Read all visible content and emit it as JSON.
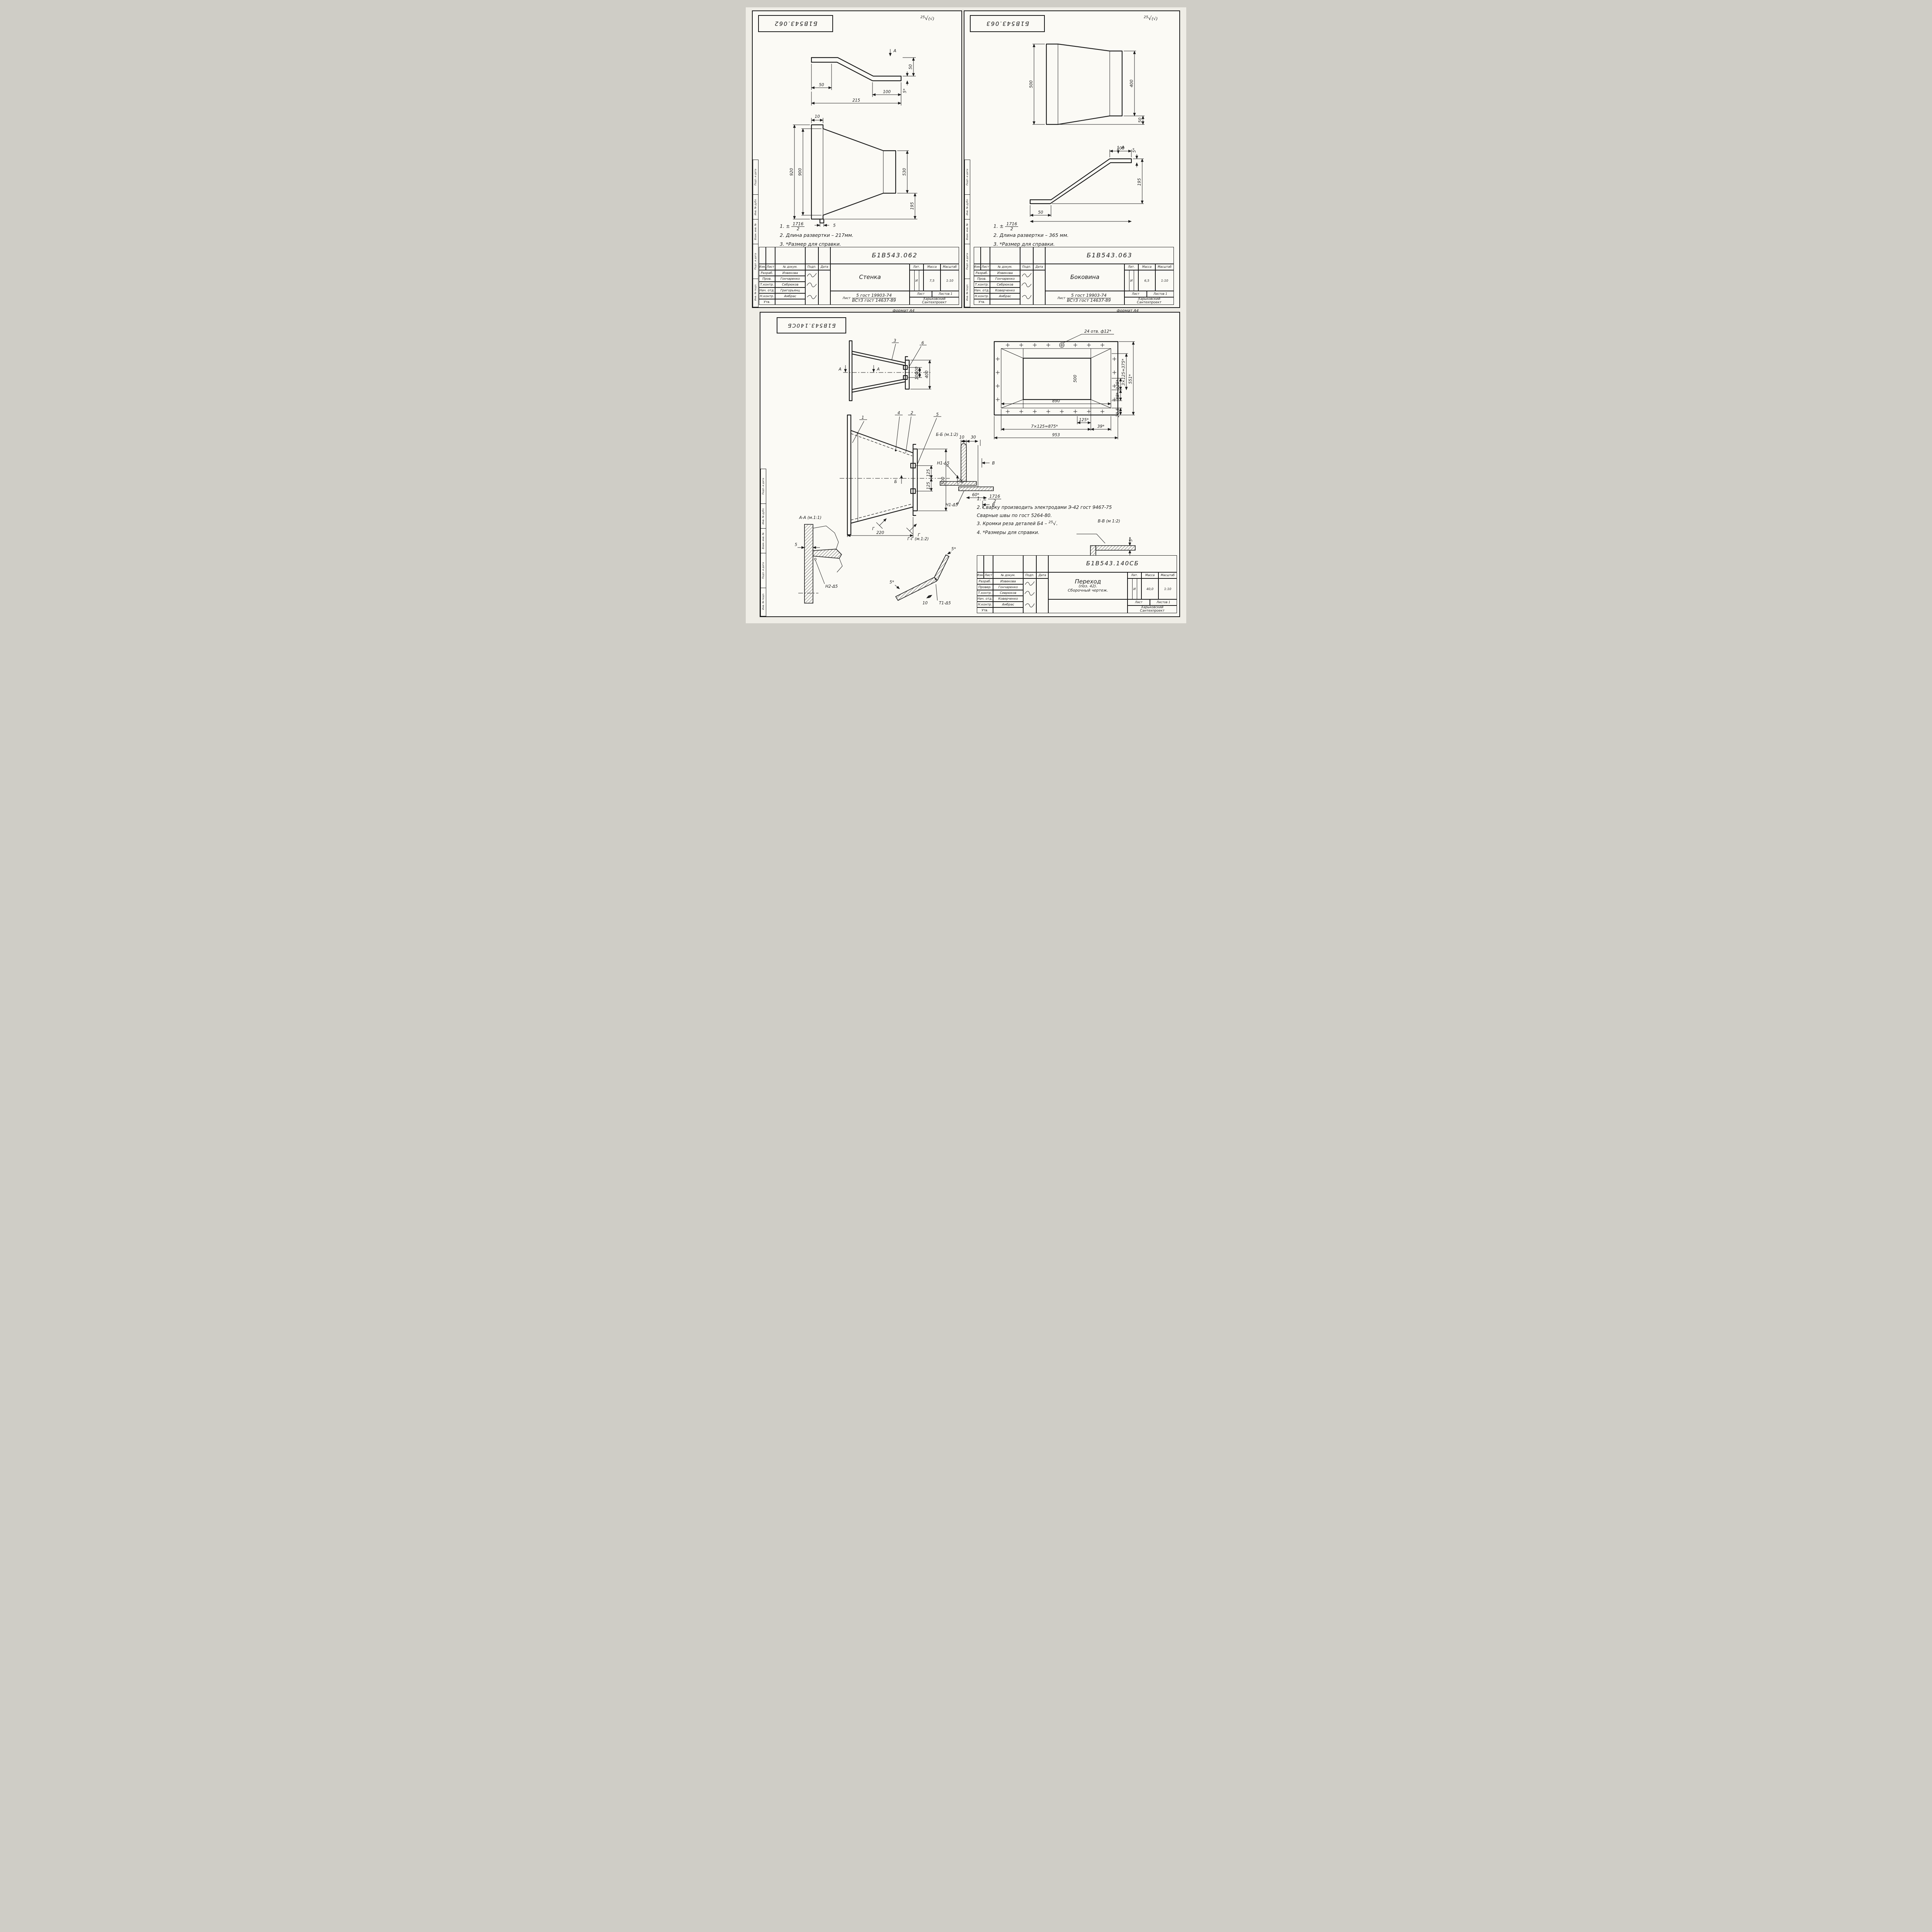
{
  "page": {
    "album_label": "Альбом 16",
    "check": "√",
    "check_paren": "(√)"
  },
  "frame_labels": {
    "l1": "Подп. и дата",
    "l2": "Инв. № дубл.",
    "l3": "Взам. инв. №",
    "l4": "Подп. и дата",
    "l5": "Инв. № подл."
  },
  "hdr": {
    "izm": "Изм.",
    "list": "Лист",
    "doc": "№ докум.",
    "podp": "Подп.",
    "data": "Дата",
    "lit": "Лит.",
    "massa": "Масса",
    "masshtab": "Масштаб",
    "list2": "Лист",
    "listov": "Листов"
  },
  "sheets": [
    {
      "doc_number": "Б1В543.062",
      "format_label": "формат А4",
      "roughness": {
        "value": "25"
      },
      "titleblock": {
        "doc_number": "Б1В543.062",
        "name": "Стенка",
        "lit": "И",
        "massa": "7,5",
        "scale": "1:10",
        "material_prefix": "Лист",
        "material_top": "5 гост 19903-74",
        "material_bottom": "ВСт3 гост 14637-89",
        "org1": "Харьковский",
        "org2": "Сантехпроект",
        "listov_value": "1",
        "staff": [
          {
            "role": "Разраб.",
            "name": "Извекова"
          },
          {
            "role": "Пров.",
            "name": "Гончаренко"
          },
          {
            "role": "Т.контр.",
            "name": "Себрюков"
          },
          {
            "role": "Нач. отд.",
            "name": "Григорьянц"
          },
          {
            "role": "Н.контр.",
            "name": "Амбрас"
          },
          {
            "role": "Утв.",
            "name": ""
          }
        ]
      },
      "notes": {
        "n1_prefix": "1. ±",
        "n1_num": "1716",
        "n1_den": "2",
        "n2": "2. Длина развертки – 217мм.",
        "n3": "3. *Размер для справки."
      },
      "dims": {
        "v1": {
          "d50l": "50",
          "d100": "100",
          "d215": "215",
          "d50r": "50",
          "d5s": "5*",
          "a": "А"
        },
        "v2": {
          "d10": "10",
          "d920": "920",
          "d900": "900",
          "d530": "530",
          "d195": "195",
          "d5": "5"
        }
      }
    },
    {
      "doc_number": "Б1В543.063",
      "format_label": "формат А4",
      "roughness": {
        "value": "25"
      },
      "titleblock": {
        "doc_number": "Б1В543.063",
        "name": "Боковина",
        "lit": "И",
        "massa": "6,5",
        "scale": "1:10",
        "material_prefix": "Лист",
        "material_top": "5 гост 19903-74",
        "material_bottom": "ВСт3 гост 14637-89",
        "org1": "Харьковский",
        "org2": "Сантехпроект",
        "listov_value": "1",
        "staff": [
          {
            "role": "Разраб.",
            "name": "Извекова"
          },
          {
            "role": "Пров.",
            "name": "Гончаренко"
          },
          {
            "role": "Т.контр.",
            "name": "Себрюков"
          },
          {
            "role": "Нач. отд.",
            "name": "Коверченко"
          },
          {
            "role": "Н.контр.",
            "name": "Амбрас"
          },
          {
            "role": "Утв.",
            "name": ""
          }
        ]
      },
      "notes": {
        "n1_prefix": "1. ±",
        "n1_num": "1716",
        "n1_den": "2",
        "n2": "2. Длина развертки – 365 мм.",
        "n3": "3. *Размер для справки."
      },
      "dims": {
        "v1": {
          "d500": "500",
          "d400": "400",
          "d50": "50"
        },
        "v2": {
          "d50": "50",
          "d100": "100",
          "d195": "195",
          "d5s": "5*",
          "a": "А"
        }
      }
    },
    {
      "doc_number": "Б1В543.140СБ",
      "titleblock": {
        "doc_number": "Б1В543.140СБ",
        "name": "Переход",
        "name_sub": "(поз. 42).",
        "name_type": "Сборочный чертеж.",
        "lit": "И",
        "massa": "40,0",
        "scale": "1:10",
        "material_prefix": "",
        "material_top": "",
        "material_bottom": "",
        "org1": "Харьковский",
        "org2": "Сантехпроект",
        "listov_value": "1",
        "staff": [
          {
            "role": "Разраб.",
            "name": "Извекова"
          },
          {
            "role": "Провер.",
            "name": "Гончаренко"
          },
          {
            "role": "Т.контр.",
            "name": "Севрюков"
          },
          {
            "role": "Нач. отд.",
            "name": "Коверченко"
          },
          {
            "role": "Н.контр.",
            "name": "Амбрас"
          },
          {
            "role": "Утв.",
            "name": ""
          }
        ]
      },
      "notes": {
        "n1_prefix": "1. ±",
        "n1_num": "1716",
        "n1_den": "2",
        "n2a": "2. Сварку производить электродами Э-42 гост 9467-75",
        "n2b": "Сварные швы по гост 5264-80.",
        "n3_text": "3. Кромки реза деталей Б4 –",
        "n3_mark": "25",
        "n3_check": "√.",
        "n4": "4. *Размеры для справки."
      },
      "sections": {
        "aa": "А-А (м.1:1)",
        "gg": "Г-Г (м.1:2)",
        "bb": "Б-Б (м.1:2)",
        "vv": "В-В (м 1:2)"
      },
      "dims": {
        "v1": {
          "c3": "3",
          "c6": "6",
          "d100a": "100",
          "d100b": "100",
          "d400": "400",
          "a1": "А",
          "a2": "А"
        },
        "v2": {
          "holes": "24 отв. ф12*",
          "d890": "890",
          "d500": "500",
          "d125r": "125*",
          "d375": "3×125=375*",
          "d88": "88*",
          "d551": "551*",
          "d205": "20,5",
          "d125b": "125*",
          "d875": "7×125=875*",
          "d39": "39*",
          "d953": "953"
        },
        "v3": {
          "c1": "1",
          "c2": "2",
          "c4": "4",
          "c5": "5",
          "b1": "Б",
          "b2": "Б",
          "g1": "Г",
          "g2": "Г",
          "d125a": "125",
          "d125b": "125",
          "d500": "500",
          "d220": "220"
        },
        "aa": {
          "d5": "5",
          "weld": "Н2-Δ5"
        },
        "gg": {
          "d5a": "5*",
          "d5b": "5*",
          "d10": "10",
          "weld": "Т1-Δ5"
        },
        "bb": {
          "d10": "10",
          "d30": "30",
          "weld1": "Н1-Δ5",
          "weld2": "Н1-Δ5",
          "d60": "60*",
          "v1": "В",
          "v2": "В"
        },
        "vv": {
          "d5a": "5*",
          "d5b": "5*"
        }
      }
    }
  ]
}
